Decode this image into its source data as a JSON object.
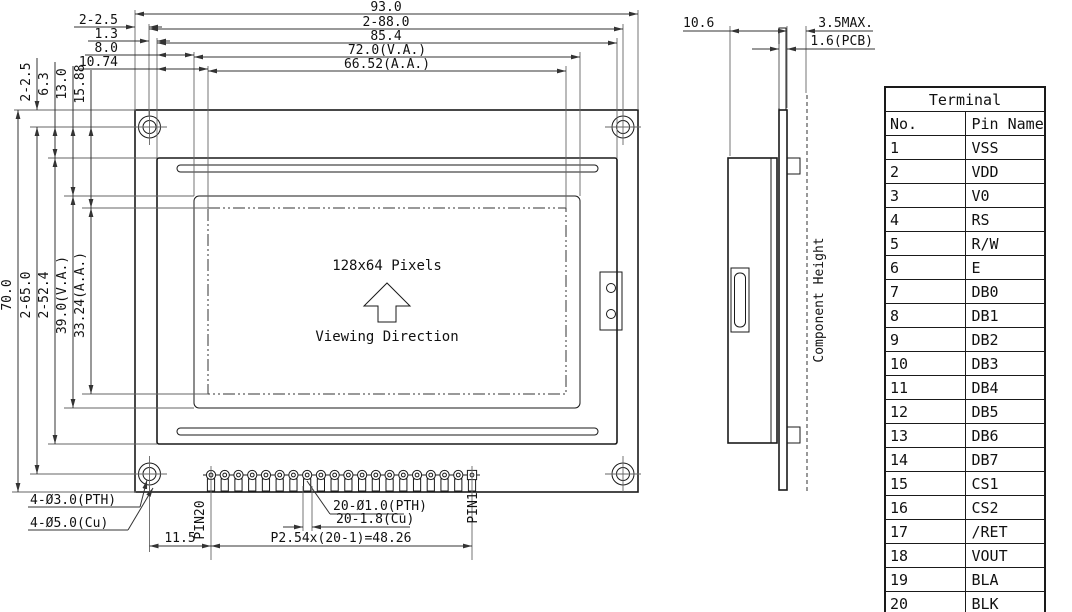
{
  "front_view": {
    "top_dims": [
      "93.0",
      "2-88.0",
      "85.4",
      "72.0(V.A.)",
      "66.52(A.A.)"
    ],
    "left_offsets": [
      "2-2.5",
      "1.3",
      "8.0",
      "10.74"
    ],
    "upper_vertical_dims": [
      "2-2.5",
      "6.3",
      "13.0",
      "15.88"
    ],
    "left_vertical_dims": [
      "70.0",
      "2-65.0",
      "2-52.4",
      "39.0(V.A.)",
      "33.24(A.A.)"
    ],
    "display": {
      "pixels": "128x64 Pixels",
      "viewing": "Viewing Direction"
    },
    "bottom_dims": {
      "mount_hole_pth": "4-Ø3.0(PTH)",
      "mount_hole_cu": "4-Ø5.0(Cu)",
      "pin20_label": "PIN20",
      "pin1_label": "PIN1",
      "pin_hole": "20-Ø1.0(PTH)",
      "pin_pad": "20-1.8(Cu)",
      "pin_pitch": "P2.54x(20-1)=48.26",
      "pin_offset": "11.5"
    },
    "pin_count": 20
  },
  "side_view": {
    "total_width": "10.6",
    "component_max_height": "3.5MAX.",
    "pcb_thickness": "1.6(PCB)",
    "component_height": "Component Height"
  },
  "terminal_table": {
    "title": "Terminal",
    "columns": [
      "No.",
      "Pin Name"
    ],
    "rows": [
      [
        "1",
        "VSS"
      ],
      [
        "2",
        "VDD"
      ],
      [
        "3",
        "V0"
      ],
      [
        "4",
        "RS"
      ],
      [
        "5",
        "R/W"
      ],
      [
        "6",
        "E"
      ],
      [
        "7",
        "DB0"
      ],
      [
        "8",
        "DB1"
      ],
      [
        "9",
        "DB2"
      ],
      [
        "10",
        "DB3"
      ],
      [
        "11",
        "DB4"
      ],
      [
        "12",
        "DB5"
      ],
      [
        "13",
        "DB6"
      ],
      [
        "14",
        "DB7"
      ],
      [
        "15",
        "CS1"
      ],
      [
        "16",
        "CS2"
      ],
      [
        "17",
        "/RET"
      ],
      [
        "18",
        "VOUT"
      ],
      [
        "19",
        "BLA"
      ],
      [
        "20",
        "BLK"
      ]
    ]
  },
  "colors": {
    "line": "#1a1a1a",
    "ext_line": "#666",
    "background": "#ffffff"
  }
}
